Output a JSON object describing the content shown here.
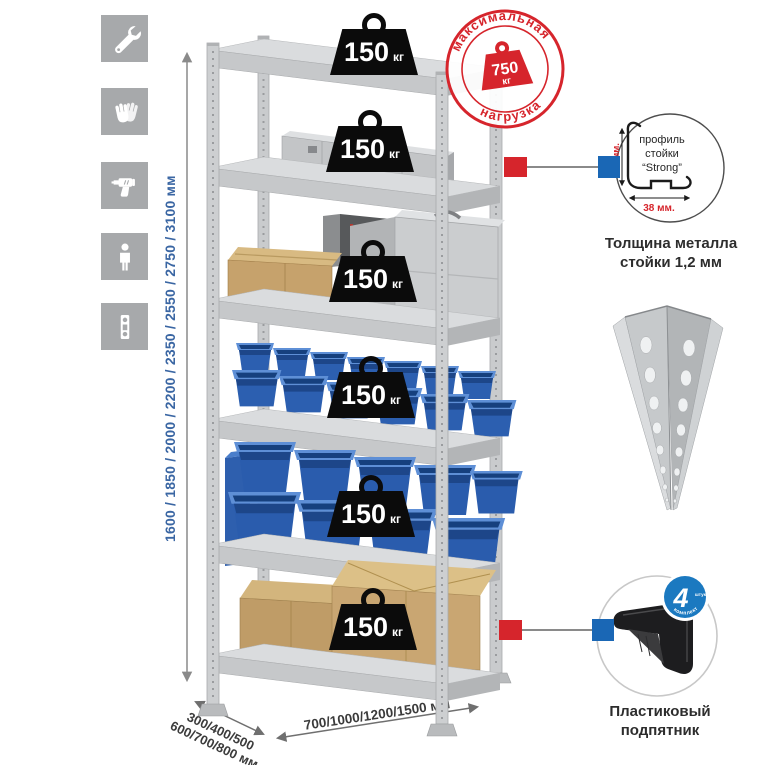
{
  "left_icons": [
    {
      "name": "wrench-icon"
    },
    {
      "name": "gloves-icon"
    },
    {
      "name": "drill-icon"
    },
    {
      "name": "person-icon"
    },
    {
      "name": "level-icon"
    }
  ],
  "height_dimension": {
    "label": "1600 / 1850 / 2000 / 2200 / 2350 / 2550 / 2750 / 3100 мм"
  },
  "shelf_weights": [
    {
      "value": "150",
      "unit": "кг"
    },
    {
      "value": "150",
      "unit": "кг"
    },
    {
      "value": "150",
      "unit": "кг"
    },
    {
      "value": "150",
      "unit": "кг"
    },
    {
      "value": "150",
      "unit": "кг"
    },
    {
      "value": "150",
      "unit": "кг"
    }
  ],
  "max_load_stamp": {
    "arc_top": "максимальная",
    "arc_bottom": "нагрузка",
    "value": "750",
    "unit": "кг"
  },
  "profile_detail": {
    "dim_vertical": "38 мм.",
    "dim_horizontal": "38 мм.",
    "label_line1": "профиль",
    "label_line2": "стойки",
    "label_line3": "“Strong”",
    "caption_line1": "Толщина металла",
    "caption_line2": "стойки 1,2 мм"
  },
  "foot_detail": {
    "badge_value": "4",
    "badge_note": "штуки",
    "badge_arc": "в комплекте",
    "caption_line1": "Пластиковый",
    "caption_line2": "подпятник"
  },
  "depth_dimension": {
    "line1": "300/400/500",
    "line2": "600/700/800 мм"
  },
  "width_dimension": {
    "label": "700/1000/1200/1500 мм"
  },
  "colors": {
    "accent_red": "#d6252c",
    "accent_blue": "#1a67b5",
    "dimension_blue": "#3a66a3"
  }
}
